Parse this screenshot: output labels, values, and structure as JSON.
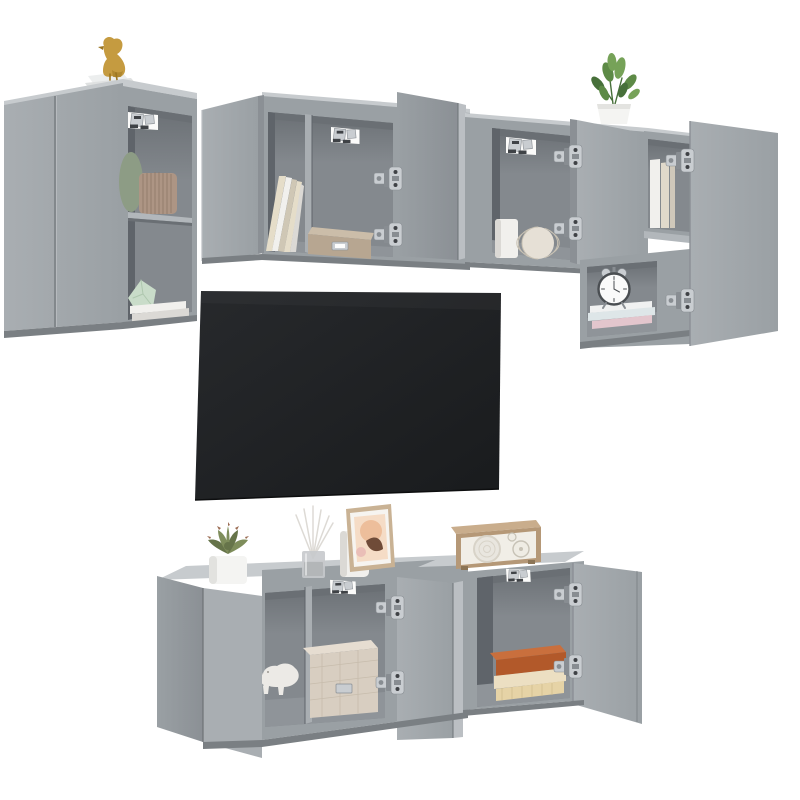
{
  "canvas": {
    "width": 800,
    "height": 800,
    "background": "#ffffff"
  },
  "scene": {
    "type": "product-photo",
    "subject": "6-piece wall-mounted TV cabinet set, concrete grey, with open doors and styling decor on white background",
    "objects": [
      "gold bird figurine",
      "stacked white books plinth",
      "green vase",
      "pleated taupe vase",
      "mint geometric vase",
      "wall-mount bracket",
      "leaning cream books",
      "wooden storage box",
      "potted green plant",
      "white cylinder vase",
      "ribbed sphere vase",
      "white alarm clock",
      "stacked pastel books",
      "flat-screen tv",
      "succulent in white pot",
      "reed diffuser",
      "white pillar candle",
      "framed abstract art",
      "retro wooden radio",
      "white rhino figurine",
      "quilted fabric storage box",
      "stacked hardcover books",
      "silver cup hinges"
    ]
  },
  "palette": {
    "bg": "#ffffff",
    "cab": "#9aa0a4",
    "cabLight": "#a9aeb2",
    "cabLighter": "#bbbfc3",
    "cabDark": "#8b9095",
    "cabTop": "#c7cbce",
    "cabBottom": "#7a7f83",
    "seam": "#6e7377",
    "intBack": "#84898e",
    "intSide": "#5f646a",
    "intShadow": "#6a6f74",
    "intFloor": "#8f9499",
    "shelf": "#b2b7bb",
    "tv1": "#27292c",
    "tv2": "#191b1d",
    "silver": "#c9cdd1",
    "silverDark": "#888d92",
    "slot": "#3f4246",
    "gold": "#c59b40",
    "goldDark": "#9c7620",
    "plant": "#5d8a46",
    "plantDark": "#47703a",
    "plantLight": "#76a258",
    "potWhite": "#f4f4f2",
    "succ": "#7e8d5b",
    "succDark": "#66744a",
    "succTip": "#9a6b52",
    "greenVase": "#8d9c85",
    "pleat": "#ad9584",
    "pleatDark": "#8f7868",
    "mint": "#c9dcc9",
    "mintDark": "#aec7ae",
    "whiteObj": "#f1f0ed",
    "whiteObjShade": "#dbd9d5",
    "cream": "#e5ddc9",
    "creamDark": "#cfc7b5",
    "wood": "#b7a691",
    "woodLight": "#cbbda9",
    "fabric": "#d8cec1",
    "fabricLight": "#e6ddd1",
    "fabricLine": "#c3b8a8",
    "bookOrange": "#b2592a",
    "bookOrangeLight": "#c96f3d",
    "bookCream": "#ecdfc2",
    "bookPale": "#e6d3a6",
    "radioWood": "#b59877",
    "radioWoodLight": "#c9ad8c",
    "radioFace": "#f1eee7",
    "radioDetail": "#d8d3c8",
    "frameWood": "#c9b294",
    "mat": "#f6f4f0",
    "artBg": "#f5dcc6",
    "artPeach": "#edbe9b",
    "artBrown": "#6f4b38",
    "artPink": "#e8b8b4",
    "clockWhite": "#fafafa",
    "clockDark": "#4a4e52",
    "pinkBook": "#e3c6cd",
    "tealBook": "#dee6e8"
  }
}
